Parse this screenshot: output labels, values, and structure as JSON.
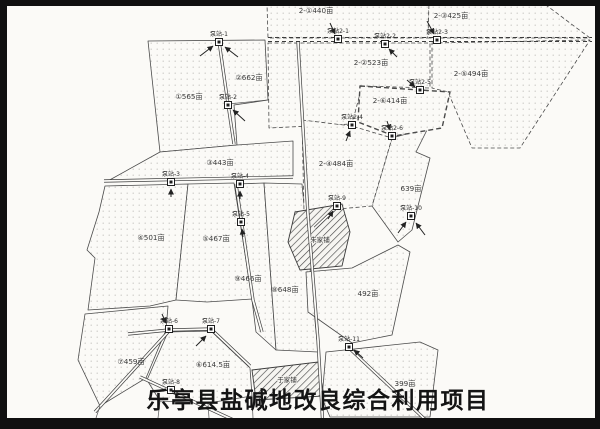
{
  "title": "乐亭县盐碱地改良综合利用项目",
  "parcel_labels": {
    "p1": "①565亩",
    "p2": "②662亩",
    "p3": "③443亩",
    "p4": "④501亩",
    "p5": "⑤467亩",
    "p6": "⑥614.5亩",
    "p7": "⑦459亩",
    "p8": "⑧648亩",
    "p9": "⑨466亩",
    "s2_1": "2-①440亩",
    "s2_2": "2-②523亩",
    "s2_3": "2-③425亩",
    "s2_4": "2-④484亩",
    "s2_5": "2-⑤494亩",
    "s2_6": "2-⑥414亩",
    "a639": "639亩",
    "a492": "492亩",
    "a399": "399亩"
  },
  "pump_labels": {
    "b1": "泵站-1",
    "b2": "泵站-2",
    "b3": "泵站-3",
    "b4": "泵站-4",
    "b5": "泵站-5",
    "b6": "泵站-6",
    "b7": "泵站-7",
    "b8": "泵站-8",
    "b9": "泵站-9",
    "b10": "泵站-10",
    "b11": "泵站-11",
    "c1": "泵站2-1",
    "c2": "泵站2-2",
    "c3": "泵站2-3",
    "c4": "泵站2-4",
    "c5": "泵站2-5",
    "c6": "泵站2-6"
  },
  "villages": {
    "v1": "朱家铺",
    "v2": "于家铺"
  }
}
